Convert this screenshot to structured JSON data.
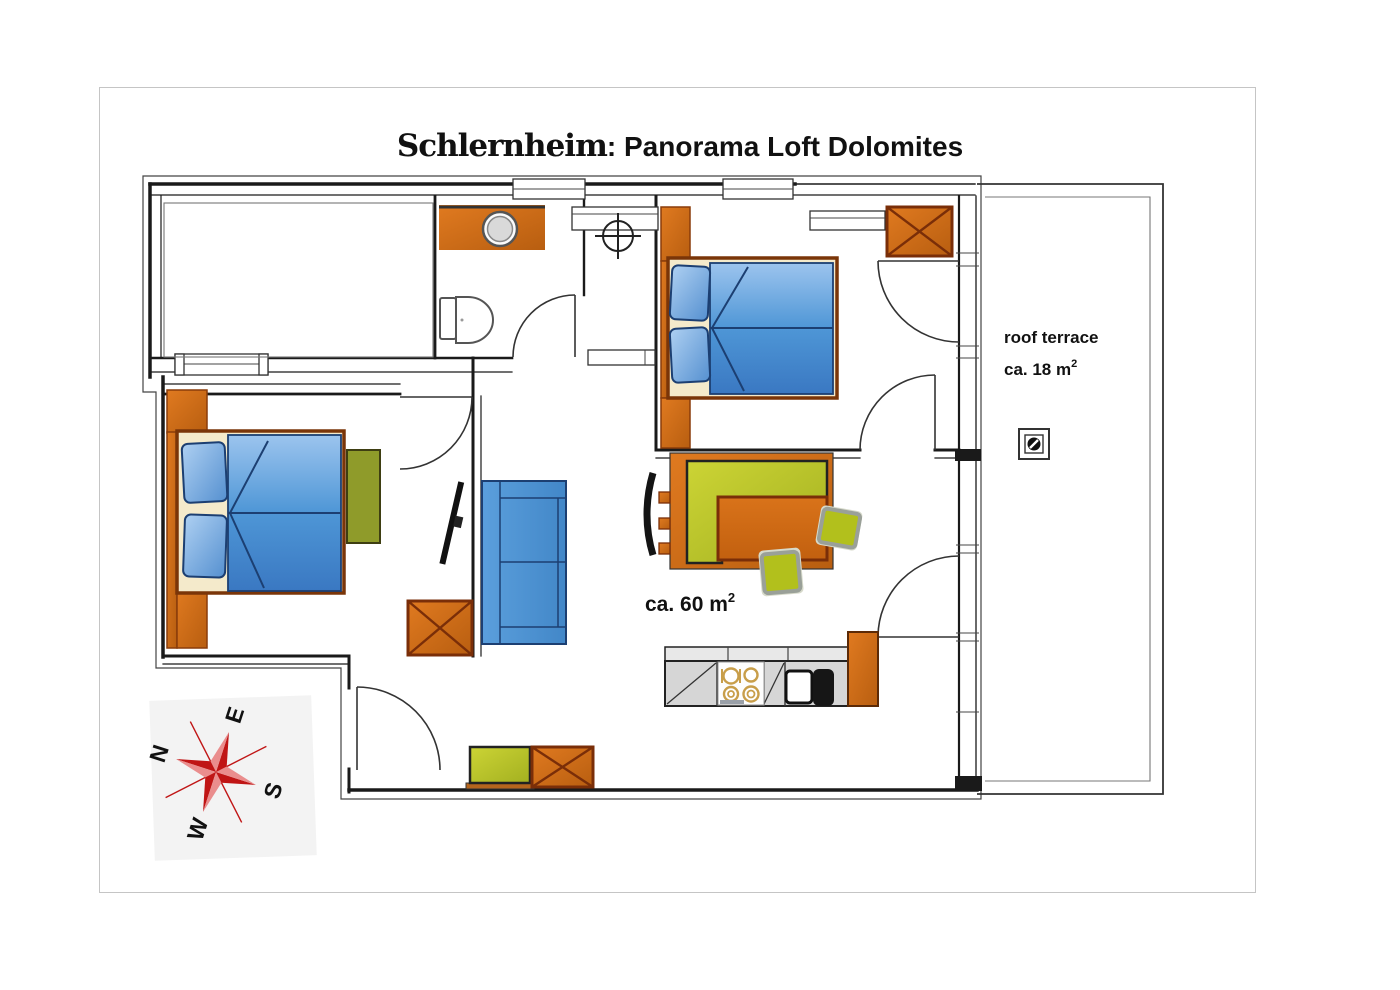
{
  "title": {
    "property_name": "Schlernheim",
    "separator": ":",
    "apartment_name": " Panorama Loft Dolomites"
  },
  "labels": {
    "living_area_text": "ca. 60 m",
    "living_area_sup": "2",
    "terrace_name": "roof terrace",
    "terrace_area_text": "ca. 18 m",
    "terrace_area_sup": "2"
  },
  "compass": {
    "north": "N",
    "east": "E",
    "south": "S",
    "west": "W"
  },
  "colors": {
    "furniture_orange": "#d2691e",
    "furniture_orange_dark": "#b85e10",
    "wood_dark": "#7a2e08",
    "bed_frame_brown": "#7a3508",
    "mattress_blue": "#4e96d6",
    "mattress_blue_light": "#9cc4ee",
    "mattress_blue_deep": "#3a78c2",
    "outline_navy": "#1c3f72",
    "bed_base_cream": "#f4eacb",
    "bench_green": "#c2cc32",
    "bench_green_dark": "#a3b020",
    "nightstand_olive": "#8f9b2a",
    "stool_green": "#b2c01c",
    "stool_border_gray": "#9aa098",
    "counter_gray": "#d6d6d6",
    "counter_gray_light": "#e8e8e8",
    "burner_tan": "#c89e4a",
    "compass_red": "#c01515",
    "wall_black": "#1a1a1a"
  }
}
